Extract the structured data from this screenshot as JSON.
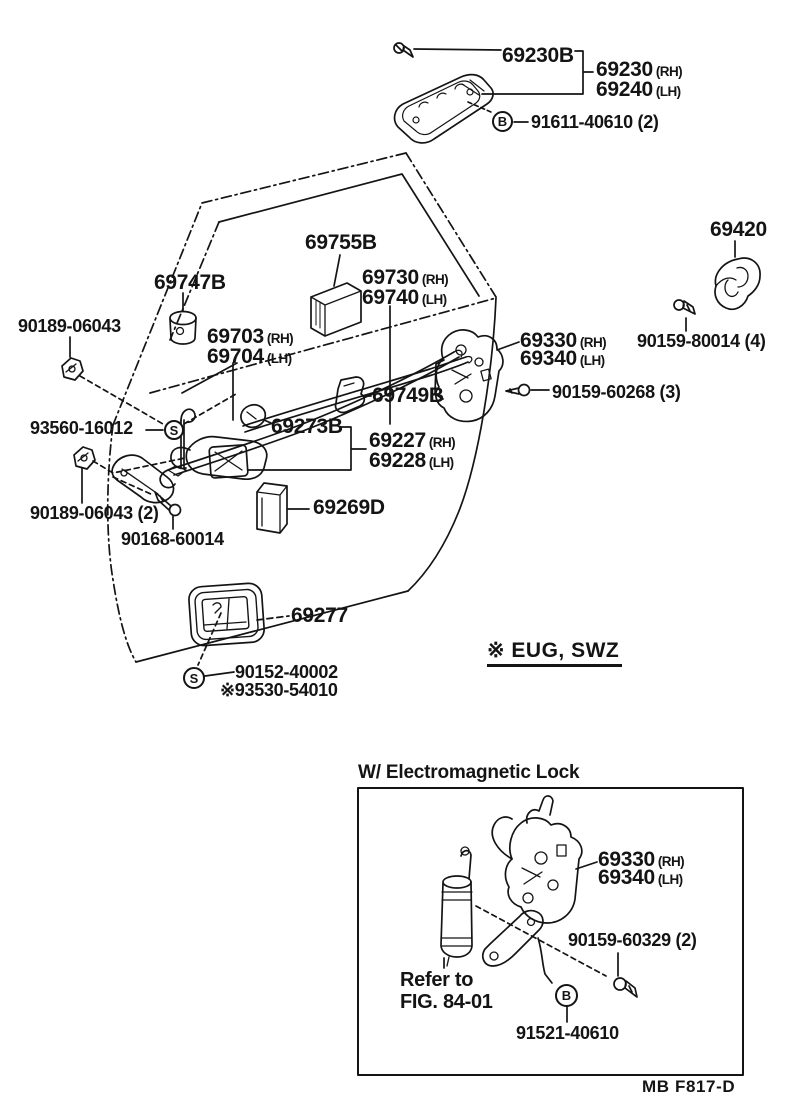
{
  "colors": {
    "ink": "#141414",
    "background": "#ffffff"
  },
  "diagram": {
    "labels": {
      "p69230B": "69230B",
      "p69230": {
        "num": "69230",
        "side": "(RH)"
      },
      "p69240": {
        "num": "69240",
        "side": "(LH)"
      },
      "p91611": "91611-40610 (2)",
      "p69420": "69420",
      "p80014": "90159-80014 (4)",
      "p69755B": "69755B",
      "p69747B": "69747B",
      "p69730": {
        "num": "69730",
        "side": "(RH)"
      },
      "p69740": {
        "num": "69740",
        "side": "(LH)"
      },
      "p69703": {
        "num": "69703",
        "side": "(RH)"
      },
      "p69704": {
        "num": "69704",
        "side": "(LH)"
      },
      "p06043": "90189-06043",
      "p69330": {
        "num": "69330",
        "side": "(RH)"
      },
      "p69340": {
        "num": "69340",
        "side": "(LH)"
      },
      "p60268": "90159-60268 (3)",
      "p69749B": "69749B",
      "p16012": "93560-16012",
      "p69273B": "69273B",
      "p69227": {
        "num": "69227",
        "side": "(RH)"
      },
      "p69228": {
        "num": "69228",
        "side": "(LH)"
      },
      "p06043b": "90189-06043 (2)",
      "p60014": "90168-60014",
      "p69269D": "69269D",
      "p69277": "69277",
      "p40002": "90152-40002",
      "p54010": "※93530-54010"
    },
    "callouts": {
      "b1": "B",
      "s1": "S",
      "s2": "S"
    },
    "note": "※ EUG, SWZ"
  },
  "inset": {
    "title": "W/ Electromagnetic Lock",
    "labels": {
      "p69330": {
        "num": "69330",
        "side": "(RH)"
      },
      "p69340": {
        "num": "69340",
        "side": "(LH)"
      },
      "p60329": "90159-60329 (2)",
      "refer_line1": "Refer to",
      "refer_line2": "FIG. 84-01",
      "p91521": "91521-40610"
    },
    "callouts": {
      "b2": "B"
    }
  },
  "footer": {
    "code": "MB  F817-D"
  }
}
